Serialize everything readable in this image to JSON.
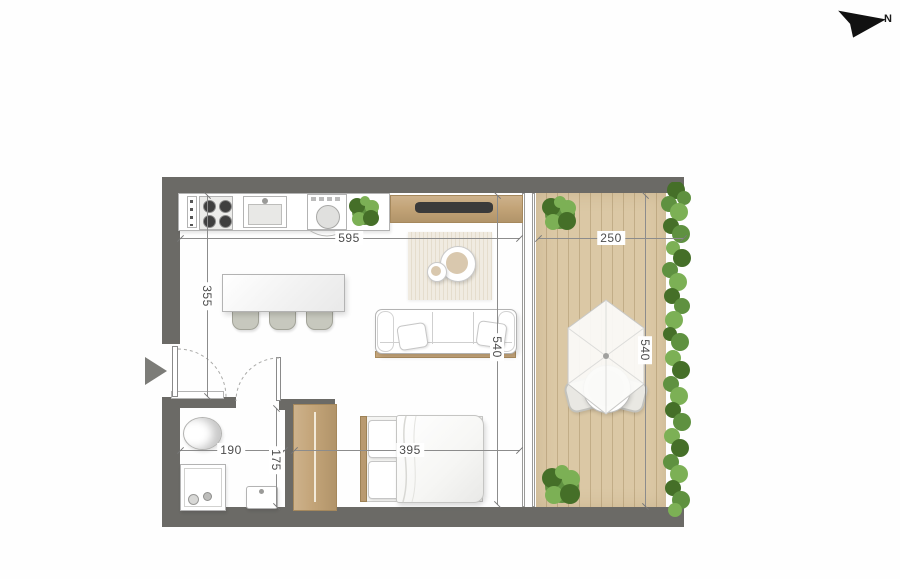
{
  "compass": {
    "label": "N"
  },
  "dimensions": [
    {
      "id": "interior-width",
      "value": "595",
      "orientation": "horizontal"
    },
    {
      "id": "balcony-width",
      "value": "250",
      "orientation": "horizontal"
    },
    {
      "id": "entry-depth",
      "value": "355",
      "orientation": "vertical"
    },
    {
      "id": "interior-depth",
      "value": "540",
      "orientation": "vertical"
    },
    {
      "id": "balcony-depth",
      "value": "540",
      "orientation": "vertical"
    },
    {
      "id": "bathroom-width",
      "value": "190",
      "orientation": "horizontal"
    },
    {
      "id": "bathroom-depth",
      "value": "175",
      "orientation": "vertical"
    },
    {
      "id": "bedroom-width",
      "value": "395",
      "orientation": "horizontal"
    }
  ],
  "colors": {
    "wall": "#6b6a66",
    "wood": "#c3a478",
    "wood_dark": "#a5885c",
    "deck": "#dbc8a5",
    "deck_line": "#c2ad87",
    "hedge_dark": "#456f28",
    "hedge_mid": "#5f9140",
    "hedge_light": "#7cb055",
    "dim_line": "#8c8c8c",
    "dim_text": "#4c4c4c",
    "tv": "#3a3a3a",
    "chair": "#c7c8be",
    "fixture_border": "#b3b3b3"
  }
}
